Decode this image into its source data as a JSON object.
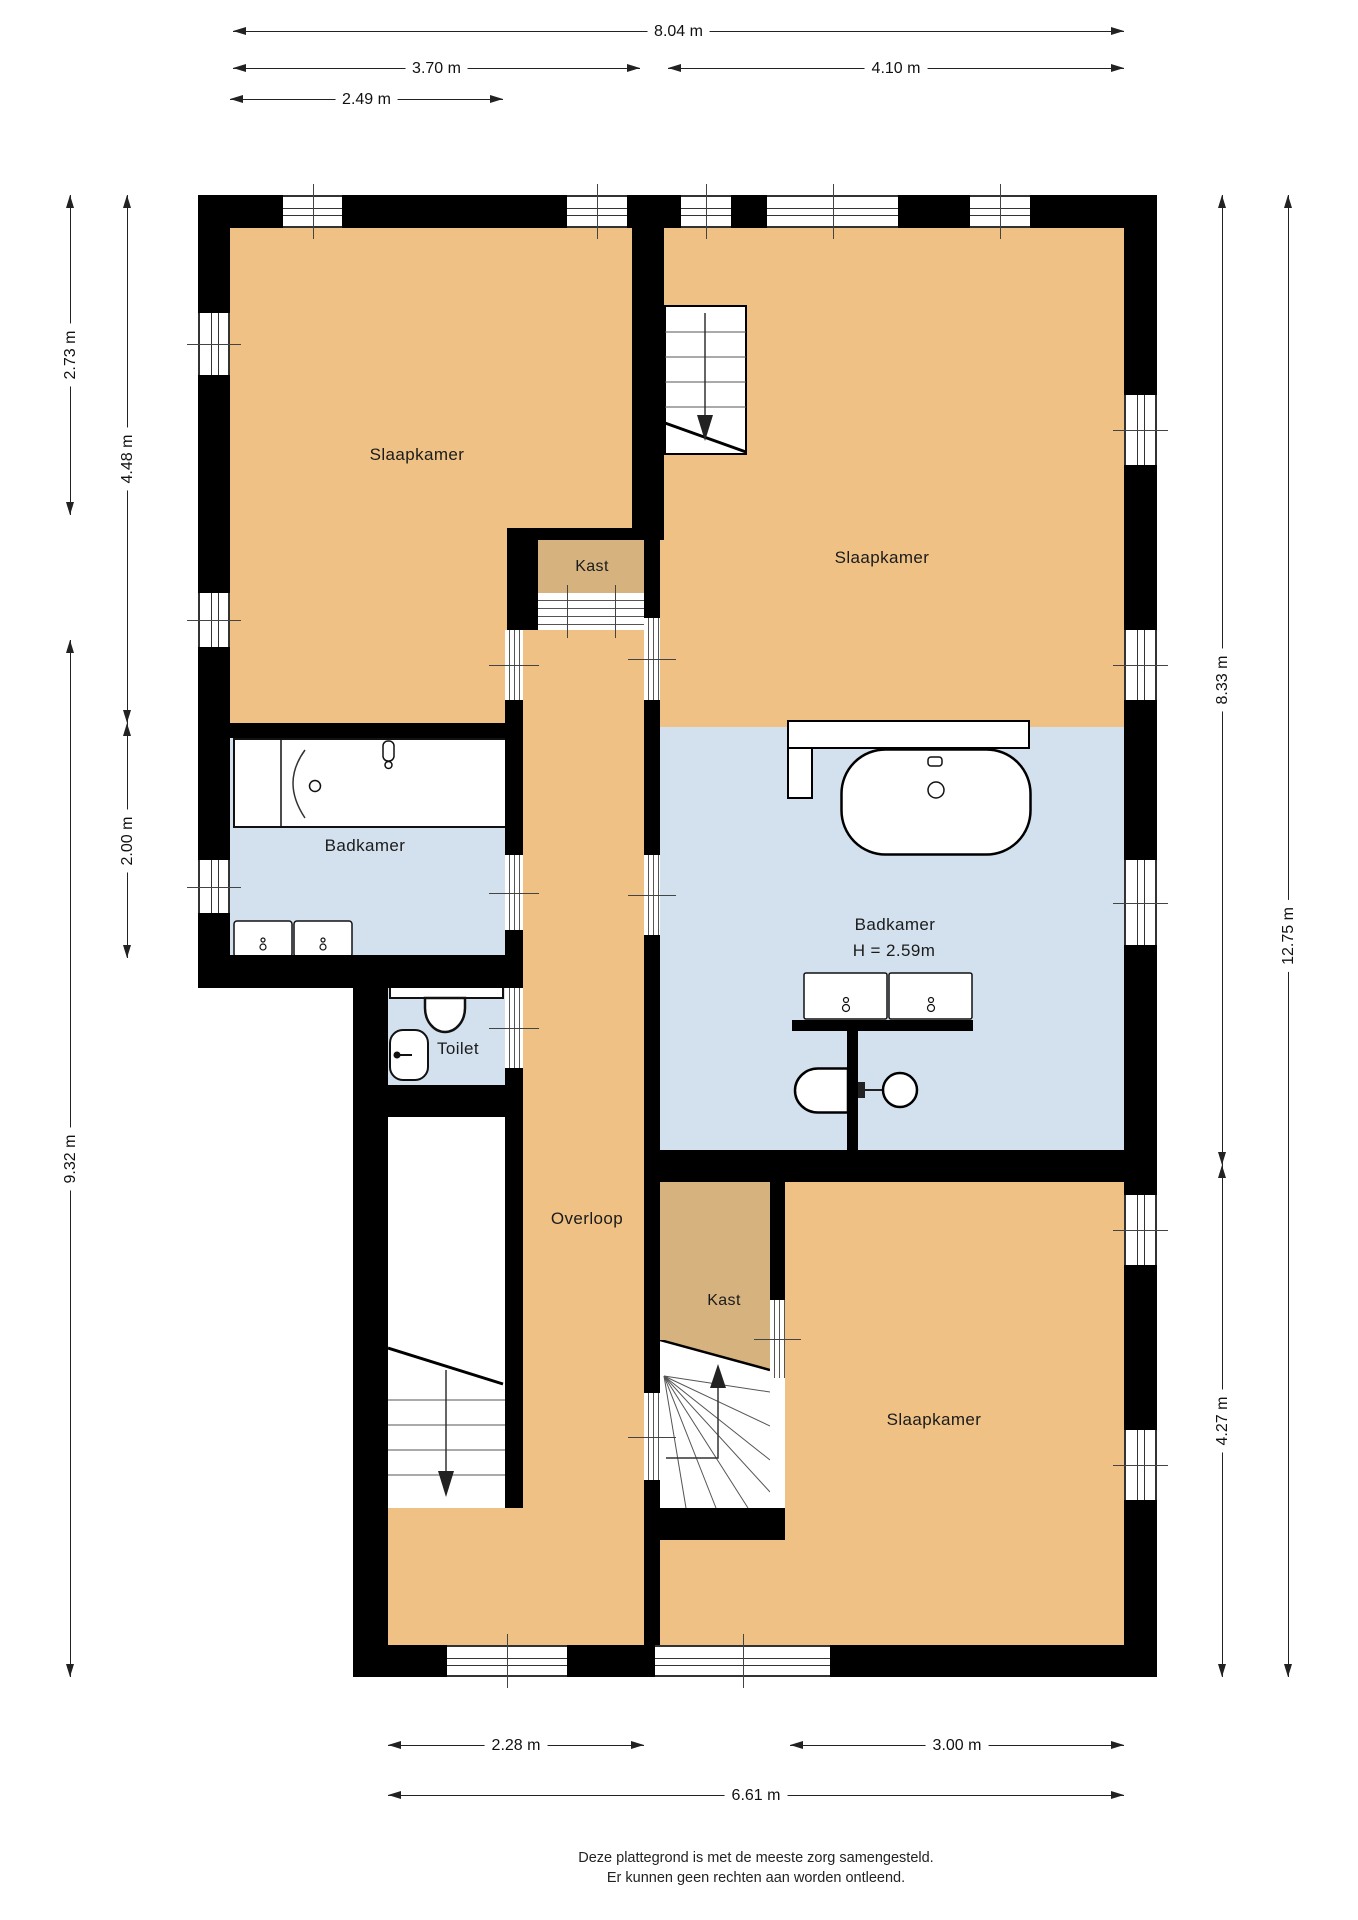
{
  "rooms": {
    "bedroom_top_left": "Slaapkamer",
    "bedroom_top_right": "Slaapkamer",
    "bedroom_bottom": "Slaapkamer",
    "closet_top": "Kast",
    "closet_bottom": "Kast",
    "bathroom_left": "Badkamer",
    "bathroom_right": "Badkamer",
    "bathroom_right_ceiling": "H = 2.59m",
    "toilet": "Toilet",
    "landing": "Overloop"
  },
  "dimensions": {
    "top": [
      "8.04 m",
      "3.70 m",
      "4.10 m",
      "2.49 m"
    ],
    "left": [
      "2.73 m",
      "4.48 m",
      "2.00 m",
      "9.32 m"
    ],
    "right": [
      "8.33 m",
      "12.75 m",
      "4.27 m"
    ],
    "bottom": [
      "2.28 m",
      "3.00 m",
      "6.61 m"
    ]
  },
  "footer": {
    "line1": "Deze plattegrond is met de meeste zorg samengesteld.",
    "line2": "Er kunnen geen rechten aan worden ontleend."
  },
  "colors": {
    "room_floor": "#efc185",
    "closet_floor": "#d6b37e",
    "bathroom_floor": "#d3e1ef",
    "wall": "#000000",
    "background": "#ffffff"
  }
}
